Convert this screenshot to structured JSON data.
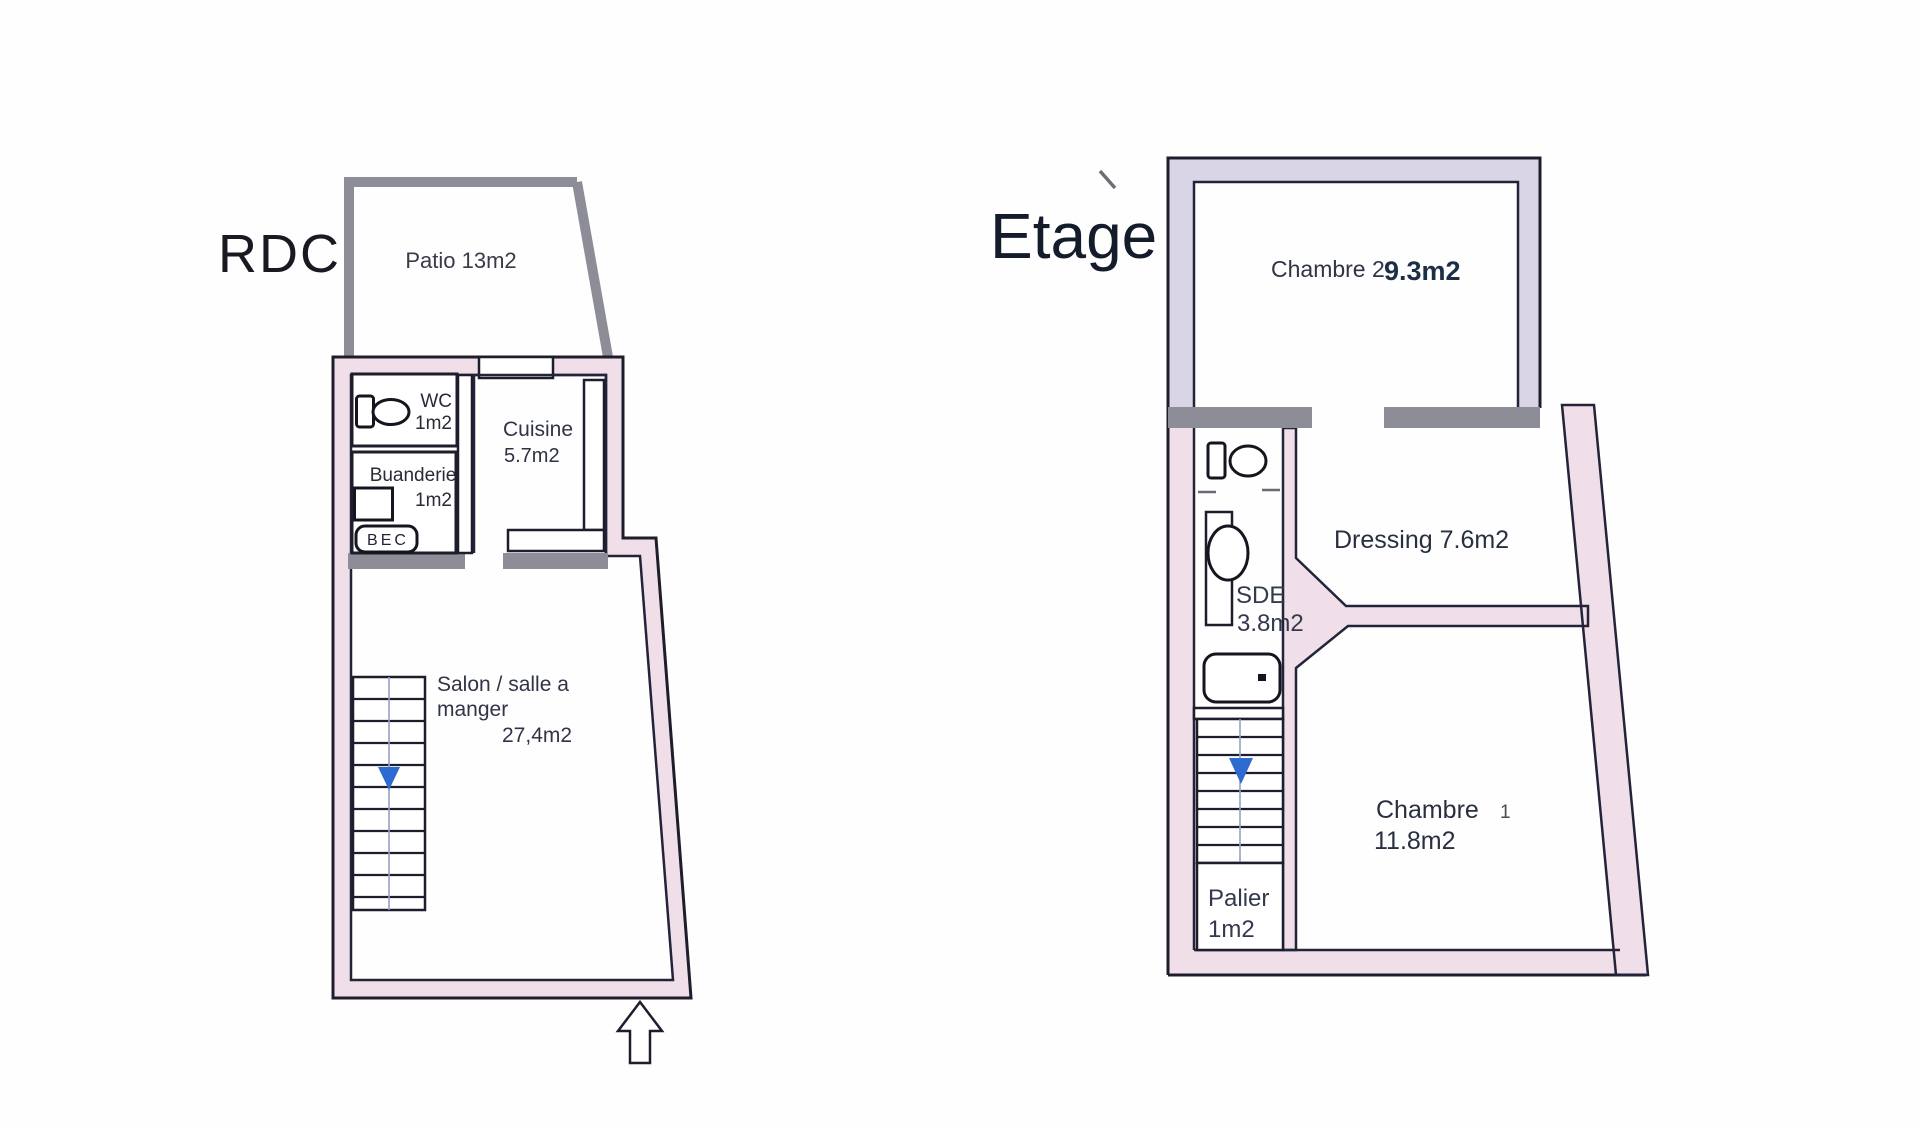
{
  "rdc": {
    "title": "RDC",
    "patio_label": "Patio 13m2",
    "wc_name": "WC",
    "wc_area": "1m2",
    "buanderie_name": "Buanderie",
    "buanderie_area": "1m2",
    "bec_label": "BEC",
    "cuisine_name": "Cuisine",
    "cuisine_area": "5.7m2",
    "salon_line1": "Salon / salle a",
    "salon_line2": "manger",
    "salon_area": "27,4m2"
  },
  "etage": {
    "title": "Etage",
    "chambre2_name": "Chambre 2",
    "chambre2_area": "9.3m2",
    "dressing_label": "Dressing 7.6m2",
    "sde_name": "SDE",
    "sde_area": "3.8m2",
    "chambre1_name": "Chambre",
    "chambre1_number": "1",
    "chambre1_area": "11.8m2",
    "palier_name": "Palier",
    "palier_area": "1m2"
  },
  "icons": [
    "toilet-icon",
    "sink-icon",
    "shower-icon",
    "washing-machine-icon",
    "stairs-down-arrow-icon",
    "entrance-arrow-icon"
  ],
  "colors": {
    "wall_pink": "#f0dfe9",
    "wall_lavender": "#d9d5e7",
    "wall_gray": "#8d8d98",
    "outline_dark": "#1d1d2c",
    "arrow_blue": "#2e6bd0",
    "text_dark": "#2e3240",
    "background": "#fefefe"
  }
}
